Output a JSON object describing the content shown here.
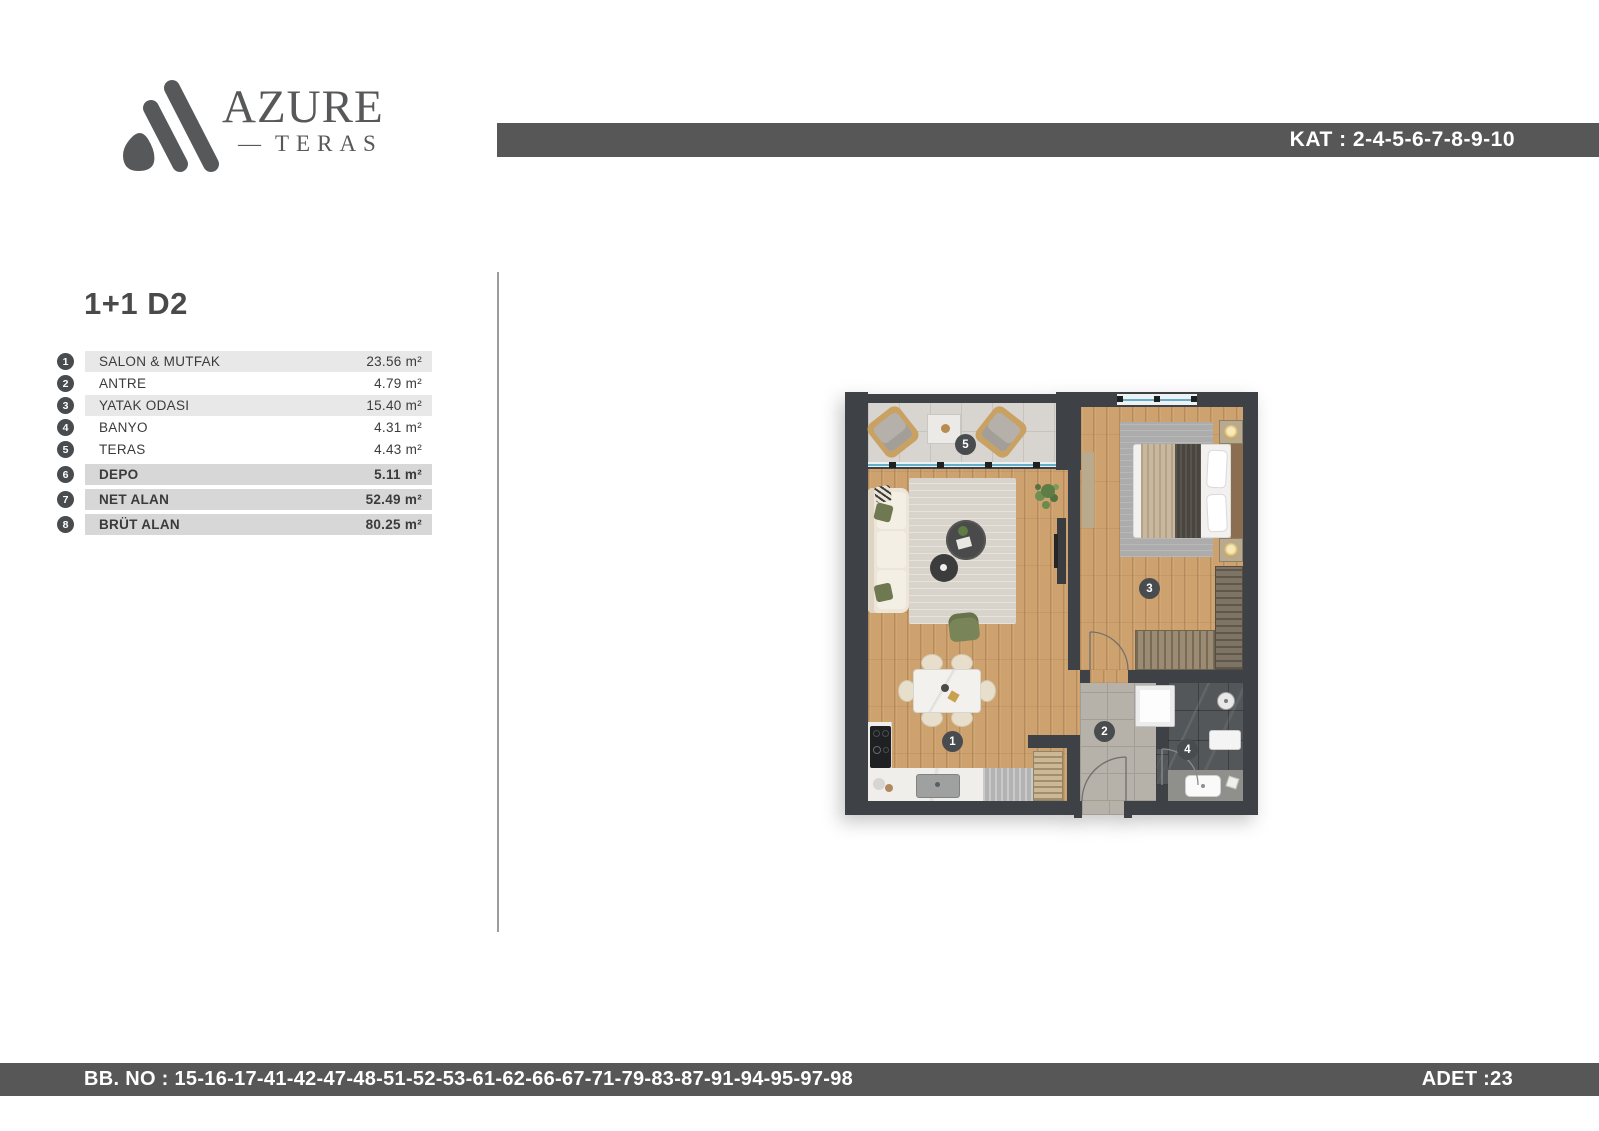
{
  "brand": {
    "name": "AZURE",
    "dash": "—",
    "subtitle": "TERAS"
  },
  "header": {
    "kat": "KAT : 2-4-5-6-7-8-9-10"
  },
  "unit": {
    "title": "1+1 D2",
    "rows": [
      {
        "no": "1",
        "label": "SALON & MUTFAK",
        "area": "23.56 m²"
      },
      {
        "no": "2",
        "label": "ANTRE",
        "area": "4.79 m²"
      },
      {
        "no": "3",
        "label": "YATAK ODASI",
        "area": "15.40 m²"
      },
      {
        "no": "4",
        "label": "BANYO",
        "area": "4.31 m²"
      },
      {
        "no": "5",
        "label": "TERAS",
        "area": "4.43 m²"
      },
      {
        "no": "6",
        "label": "DEPO",
        "area": "5.11 m²"
      },
      {
        "no": "7",
        "label": "NET ALAN",
        "area": "52.49 m²"
      },
      {
        "no": "8",
        "label": "BRÜT ALAN",
        "area": "80.25 m²"
      }
    ]
  },
  "plan": {
    "badges": [
      {
        "no": "1"
      },
      {
        "no": "2"
      },
      {
        "no": "3"
      },
      {
        "no": "4"
      },
      {
        "no": "5"
      }
    ]
  },
  "footer": {
    "bb_no": "BB. NO : 15-16-17-41-42-47-48-51-52-53-61-62-66-67-71-79-83-87-91-94-95-97-98",
    "adet": "ADET :23"
  },
  "colors": {
    "bar": "#575757",
    "wall": "#3e4145",
    "accent_wood": "#cda26f"
  }
}
